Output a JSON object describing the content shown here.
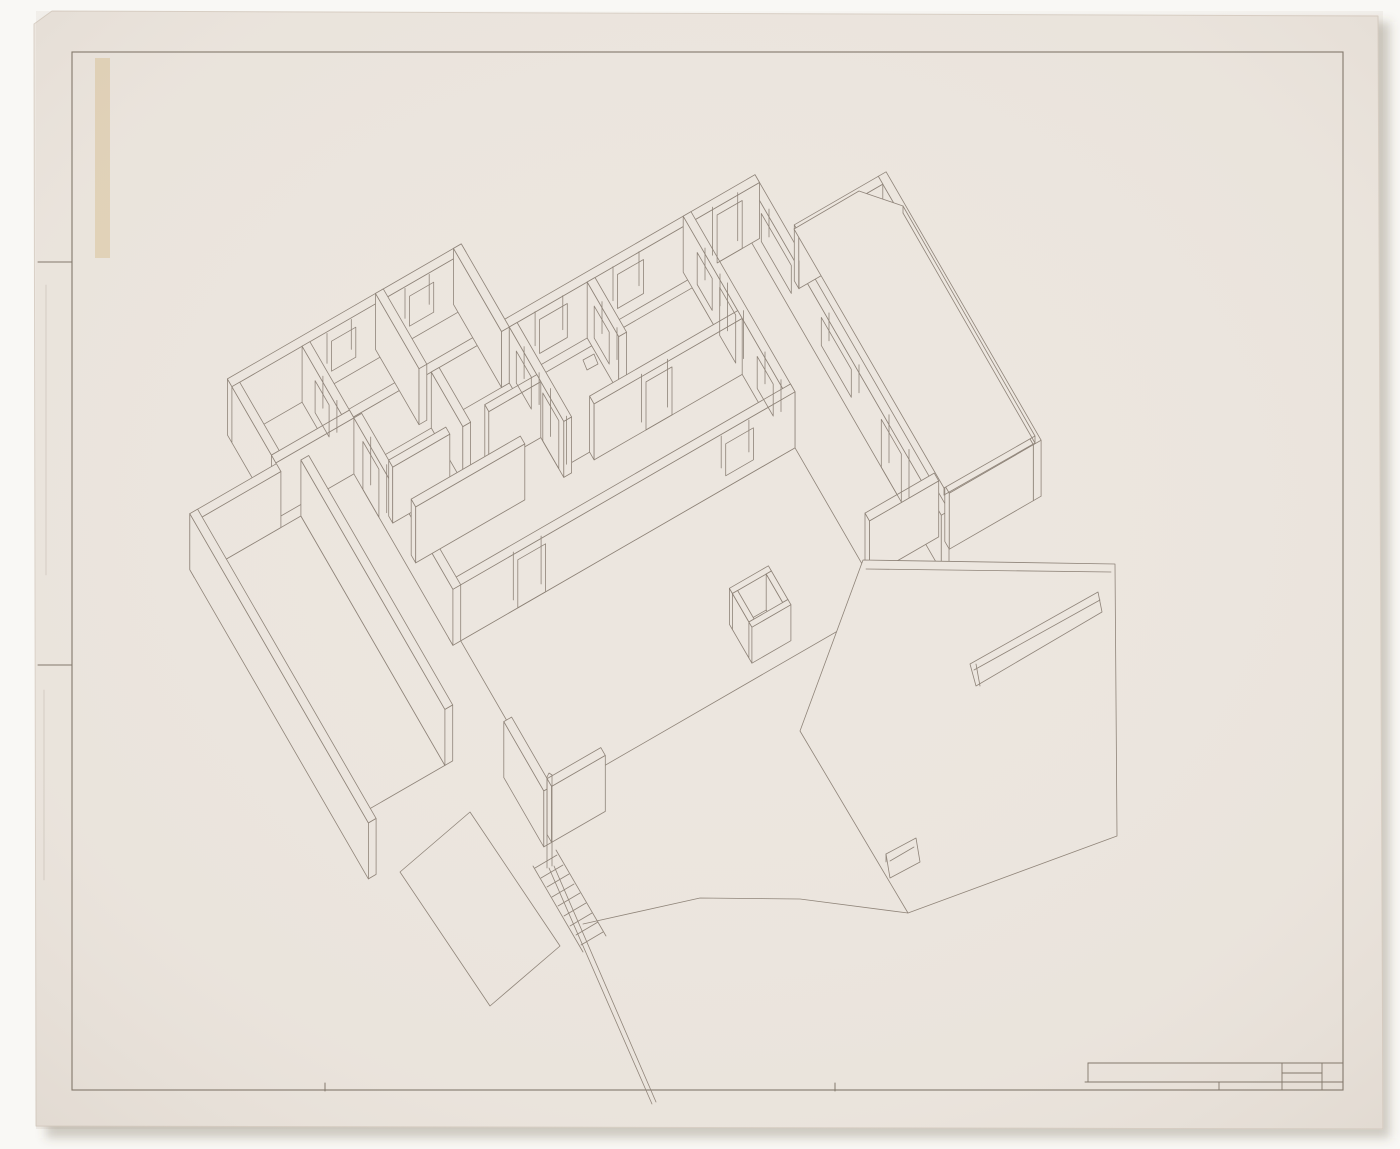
{
  "canvas": {
    "width": 1400,
    "height": 1149,
    "background": "#f9f8f5"
  },
  "palette": {
    "paper": "#ece6df",
    "paper_edge": "#d9d0c6",
    "line": "#8d8277",
    "border": "#7e7468",
    "shadow": "rgba(95,80,62,0.28)",
    "tape": "rgba(213,186,134,0.42)",
    "vignette": "rgba(150,130,112,0.13)"
  },
  "sheet": {
    "outline": [
      [
        52,
        11
      ],
      [
        1378,
        16
      ],
      [
        1383,
        1129
      ],
      [
        36,
        1126
      ],
      [
        34,
        24
      ]
    ],
    "shadow_rect": [
      46,
      22,
      1344,
      1116
    ],
    "tape_rect": [
      95,
      58,
      15,
      200
    ]
  },
  "border": {
    "rect": [
      72,
      52,
      1271,
      1038
    ],
    "fold_ticks": [
      [
        38,
        262,
        72,
        262
      ],
      [
        38,
        665,
        72,
        665
      ],
      [
        325,
        1083,
        325,
        1091
      ],
      [
        835,
        1083,
        835,
        1091
      ]
    ],
    "faint_folds": [
      [
        46,
        285,
        46,
        575
      ],
      [
        44,
        690,
        44,
        880
      ]
    ]
  },
  "title_block": {
    "h_lines": [
      [
        1088,
        1063,
        1343,
        1063
      ],
      [
        1282,
        1073,
        1322,
        1073
      ],
      [
        1085,
        1082,
        1343,
        1082
      ]
    ],
    "v_lines": [
      [
        1088,
        1063,
        1088,
        1082
      ],
      [
        1219,
        1082,
        1219,
        1090
      ],
      [
        1282,
        1063,
        1282,
        1090
      ],
      [
        1322,
        1063,
        1322,
        1090
      ]
    ]
  },
  "axon": {
    "projection": {
      "ox": 190,
      "oy": 520,
      "ux": 0.866,
      "uy": -0.5,
      "vx": 0.5,
      "vy": 0.866,
      "wall_height": 56,
      "line_width": 0.8
    },
    "walls": [
      {
        "u": [
          625,
          634
        ],
        "v": [
          32,
          420
        ]
      },
      {
        "u": [
          740,
          749
        ],
        "v": [
          95,
          405
        ]
      },
      {
        "u": [
          643,
          740
        ],
        "v": [
          95,
          104
        ]
      },
      {
        "u": [
          643,
          740
        ],
        "v": [
          396,
          405
        ]
      },
      {
        "u": [
          165,
          634
        ],
        "v": [
          32,
          41
        ]
      },
      {
        "u": [
          75,
          345
        ],
        "v": [
          -55,
          -46
        ]
      },
      {
        "u": [
          336,
          345
        ],
        "v": [
          -55,
          41
        ]
      },
      {
        "u": [
          75,
          84
        ],
        "v": [
          -46,
          33
        ]
      },
      {
        "u": [
          75,
          165
        ],
        "v": [
          33,
          42
        ]
      },
      {
        "u": [
          156,
          165
        ],
        "v": [
          -46,
          33
        ]
      },
      {
        "u": [
          246,
          255
        ],
        "v": [
          -55,
          32
        ]
      },
      {
        "u": [
          165,
          174
        ],
        "v": [
          42,
          240
        ]
      },
      {
        "u": [
          255,
          264
        ],
        "v": [
          41,
          104
        ]
      },
      {
        "u": [
          345,
          354
        ],
        "v": [
          41,
          150
        ]
      },
      {
        "u": [
          435,
          444
        ],
        "v": [
          41,
          104
        ]
      },
      {
        "u": [
          551,
          560
        ],
        "v": [
          32,
          240
        ]
      },
      {
        "u": [
          174,
          240
        ],
        "v": [
          96,
          104
        ]
      },
      {
        "u": [
          285,
          345
        ],
        "v": [
          96,
          104
        ]
      },
      {
        "u": [
          174,
          300
        ],
        "v": [
          141,
          150
        ]
      },
      {
        "u": [
          380,
          551
        ],
        "v": [
          141,
          150
        ]
      },
      {
        "u": [
          165,
          560
        ],
        "v": [
          231,
          240
        ]
      },
      {
        "u": [
          -25,
          -16
        ],
        "v": [
          43,
          400
        ]
      },
      {
        "u": [
          -25,
          75
        ],
        "v": [
          43,
          52
        ]
      },
      {
        "u": [
          98,
          107
        ],
        "v": [
          52,
          340
        ]
      },
      {
        "u": [
          560,
          640
        ],
        "v": [
          380,
          389
        ]
      },
      {
        "u": [
          415,
          460
        ],
        "v": [
          360,
          366
        ],
        "h": 36
      },
      {
        "u": [
          415,
          460
        ],
        "v": [
          399,
          405
        ],
        "h": 36
      },
      {
        "u": [
          415,
          421
        ],
        "v": [
          366,
          399
        ],
        "h": 36
      },
      {
        "u": [
          454,
          460
        ],
        "v": [
          366,
          399
        ],
        "h": 36
      },
      {
        "u": [
          143,
          152
        ],
        "v": [
          380,
          460
        ]
      },
      {
        "u": [
          152,
          214
        ],
        "v": [
          451,
          460
        ]
      }
    ],
    "openings": [
      {
        "wall": 4,
        "face": "S",
        "range": [
          380,
          412
        ],
        "z": [
          12,
          46
        ]
      },
      {
        "wall": 4,
        "face": "S",
        "range": [
          470,
          500
        ],
        "z": [
          12,
          46
        ]
      },
      {
        "wall": 4,
        "face": "S",
        "range": [
          585,
          614
        ],
        "z": [
          0,
          48
        ]
      },
      {
        "wall": 5,
        "face": "S",
        "range": [
          190,
          218
        ],
        "z": [
          14,
          44
        ]
      },
      {
        "wall": 5,
        "face": "S",
        "range": [
          280,
          308
        ],
        "z": [
          14,
          44
        ]
      },
      {
        "wall": 9,
        "face": "W",
        "range": [
          -20,
          8
        ],
        "z": [
          12,
          44
        ]
      },
      {
        "wall": 11,
        "face": "W",
        "range": [
          60,
          92
        ],
        "z": [
          0,
          48
        ]
      },
      {
        "wall": 13,
        "face": "W",
        "range": [
          55,
          85
        ],
        "z": [
          12,
          44
        ]
      },
      {
        "wall": 13,
        "face": "W",
        "range": [
          108,
          140
        ],
        "z": [
          0,
          48
        ]
      },
      {
        "wall": 14,
        "face": "W",
        "range": [
          55,
          85
        ],
        "z": [
          12,
          44
        ]
      },
      {
        "wall": 15,
        "face": "W",
        "range": [
          60,
          90
        ],
        "z": [
          12,
          44
        ]
      },
      {
        "wall": 15,
        "face": "W",
        "range": [
          105,
          137
        ],
        "z": [
          0,
          48
        ]
      },
      {
        "wall": 15,
        "face": "W",
        "range": [
          180,
          212
        ],
        "z": [
          12,
          44
        ]
      },
      {
        "wall": 19,
        "face": "S",
        "range": [
          440,
          470
        ],
        "z": [
          0,
          48
        ]
      },
      {
        "wall": 20,
        "face": "S",
        "range": [
          240,
          272
        ],
        "z": [
          0,
          48
        ]
      },
      {
        "wall": 20,
        "face": "S",
        "range": [
          480,
          512
        ],
        "z": [
          12,
          44
        ]
      },
      {
        "wall": 0,
        "face": "W",
        "range": [
          60,
          120
        ],
        "z": [
          18,
          46
        ]
      },
      {
        "wall": 0,
        "face": "W",
        "range": [
          180,
          240
        ],
        "z": [
          18,
          46
        ]
      },
      {
        "wall": 0,
        "face": "W",
        "range": [
          300,
          340
        ],
        "z": [
          0,
          48
        ]
      }
    ],
    "floors": [
      {
        "pts": [
          [
            -16,
            52
          ],
          [
            98,
            52
          ],
          [
            98,
            340
          ],
          [
            -16,
            340
          ]
        ]
      },
      {
        "pts": [
          [
            354,
            50
          ],
          [
            551,
            50
          ],
          [
            551,
            141
          ],
          [
            354,
            141
          ]
        ]
      },
      {
        "pts": [
          [
            174,
            240
          ],
          [
            560,
            240
          ],
          [
            560,
            420
          ],
          [
            174,
            420
          ]
        ]
      }
    ],
    "extras": [
      {
        "name": "roof-slab",
        "pts": [
          [
            794,
            229
          ],
          [
            859,
            191
          ],
          [
            903,
            206
          ],
          [
            1035,
            436
          ],
          [
            944,
            488
          ]
        ],
        "closed": true,
        "fill": true
      },
      {
        "name": "slab-fascia",
        "pts": [
          [
            903,
            206
          ],
          [
            903,
            213
          ]
        ]
      },
      {
        "name": "slab-fascia",
        "pts": [
          [
            903,
            213
          ],
          [
            1035,
            443
          ]
        ]
      },
      {
        "name": "slab-fascia",
        "pts": [
          [
            1035,
            436
          ],
          [
            1035,
            443
          ]
        ]
      },
      {
        "name": "slab-fascia",
        "pts": [
          [
            1035,
            443
          ],
          [
            944,
            495
          ]
        ]
      },
      {
        "name": "slab-fascia",
        "pts": [
          [
            944,
            488
          ],
          [
            944,
            495
          ]
        ]
      },
      {
        "name": "site-wall",
        "pts": [
          [
            863,
            560
          ],
          [
            1115,
            564
          ],
          [
            1117,
            836
          ],
          [
            908,
            913
          ],
          [
            800,
            731
          ]
        ],
        "closed": true,
        "fill": true
      },
      {
        "name": "site-wall-cap",
        "pts": [
          [
            866,
            569
          ],
          [
            1111,
            572
          ]
        ]
      },
      {
        "name": "wall-slot",
        "pts": [
          [
            970,
            664
          ],
          [
            1098,
            592
          ],
          [
            1102,
            612
          ],
          [
            976,
            686
          ]
        ],
        "closed": true
      },
      {
        "name": "wall-slot-reveal",
        "pts": [
          [
            974,
            670
          ],
          [
            1100,
            600
          ]
        ]
      },
      {
        "name": "wall-slot-jamb",
        "pts": [
          [
            976,
            664
          ],
          [
            980,
            686
          ]
        ]
      },
      {
        "name": "small-window",
        "pts": [
          [
            886,
            854
          ],
          [
            916,
            838
          ],
          [
            920,
            862
          ],
          [
            890,
            878
          ]
        ],
        "closed": true
      },
      {
        "name": "small-window-reveal",
        "pts": [
          [
            890,
            861
          ],
          [
            914,
            847
          ]
        ]
      },
      {
        "name": "small-window-jamb",
        "pts": [
          [
            886,
            854
          ],
          [
            886,
            862
          ]
        ]
      },
      {
        "name": "ground-line",
        "pts": [
          [
            583,
            924
          ],
          [
            700,
            898
          ],
          [
            800,
            899
          ],
          [
            908,
            913
          ]
        ]
      },
      {
        "name": "terrain-plate",
        "pts": [
          [
            470,
            812
          ],
          [
            560,
            946
          ],
          [
            490,
            1006
          ],
          [
            400,
            872
          ]
        ],
        "closed": true
      },
      {
        "name": "stair-stringer",
        "pts": [
          [
            533,
            866
          ],
          [
            583,
            952
          ]
        ]
      },
      {
        "name": "stair-stringer",
        "pts": [
          [
            556,
            850
          ],
          [
            606,
            936
          ]
        ]
      },
      {
        "name": "stair-tread",
        "pts": [
          [
            535,
            868
          ],
          [
            557,
            855
          ]
        ]
      },
      {
        "name": "stair-tread",
        "pts": [
          [
            541,
            878
          ],
          [
            563,
            865
          ]
        ]
      },
      {
        "name": "stair-tread",
        "pts": [
          [
            547,
            887
          ],
          [
            569,
            874
          ]
        ]
      },
      {
        "name": "stair-tread",
        "pts": [
          [
            552,
            897
          ],
          [
            574,
            884
          ]
        ]
      },
      {
        "name": "stair-tread",
        "pts": [
          [
            558,
            906
          ],
          [
            580,
            893
          ]
        ]
      },
      {
        "name": "stair-tread",
        "pts": [
          [
            564,
            916
          ],
          [
            586,
            903
          ]
        ]
      },
      {
        "name": "stair-tread",
        "pts": [
          [
            570,
            926
          ],
          [
            592,
            913
          ]
        ]
      },
      {
        "name": "stair-tread",
        "pts": [
          [
            576,
            935
          ],
          [
            598,
            922
          ]
        ]
      },
      {
        "name": "stair-tread",
        "pts": [
          [
            581,
            945
          ],
          [
            603,
            932
          ]
        ]
      },
      {
        "name": "newel-post",
        "pts": [
          [
            547,
            777
          ],
          [
            547,
            868
          ]
        ]
      },
      {
        "name": "newel-post",
        "pts": [
          [
            552,
            775
          ],
          [
            552,
            866
          ]
        ]
      },
      {
        "name": "newel-post-cap",
        "pts": [
          [
            547,
            777
          ],
          [
            549,
            773
          ],
          [
            552,
            775
          ]
        ]
      },
      {
        "name": "handrail",
        "pts": [
          [
            549,
            868
          ],
          [
            652,
            1104
          ]
        ]
      },
      {
        "name": "handrail",
        "pts": [
          [
            554,
            866
          ],
          [
            656,
            1102
          ]
        ]
      },
      {
        "name": "roof-detail-box",
        "pts": [
          [
            583,
            360
          ],
          [
            594,
            354
          ],
          [
            598,
            364
          ],
          [
            587,
            370
          ]
        ],
        "closed": true
      }
    ]
  }
}
